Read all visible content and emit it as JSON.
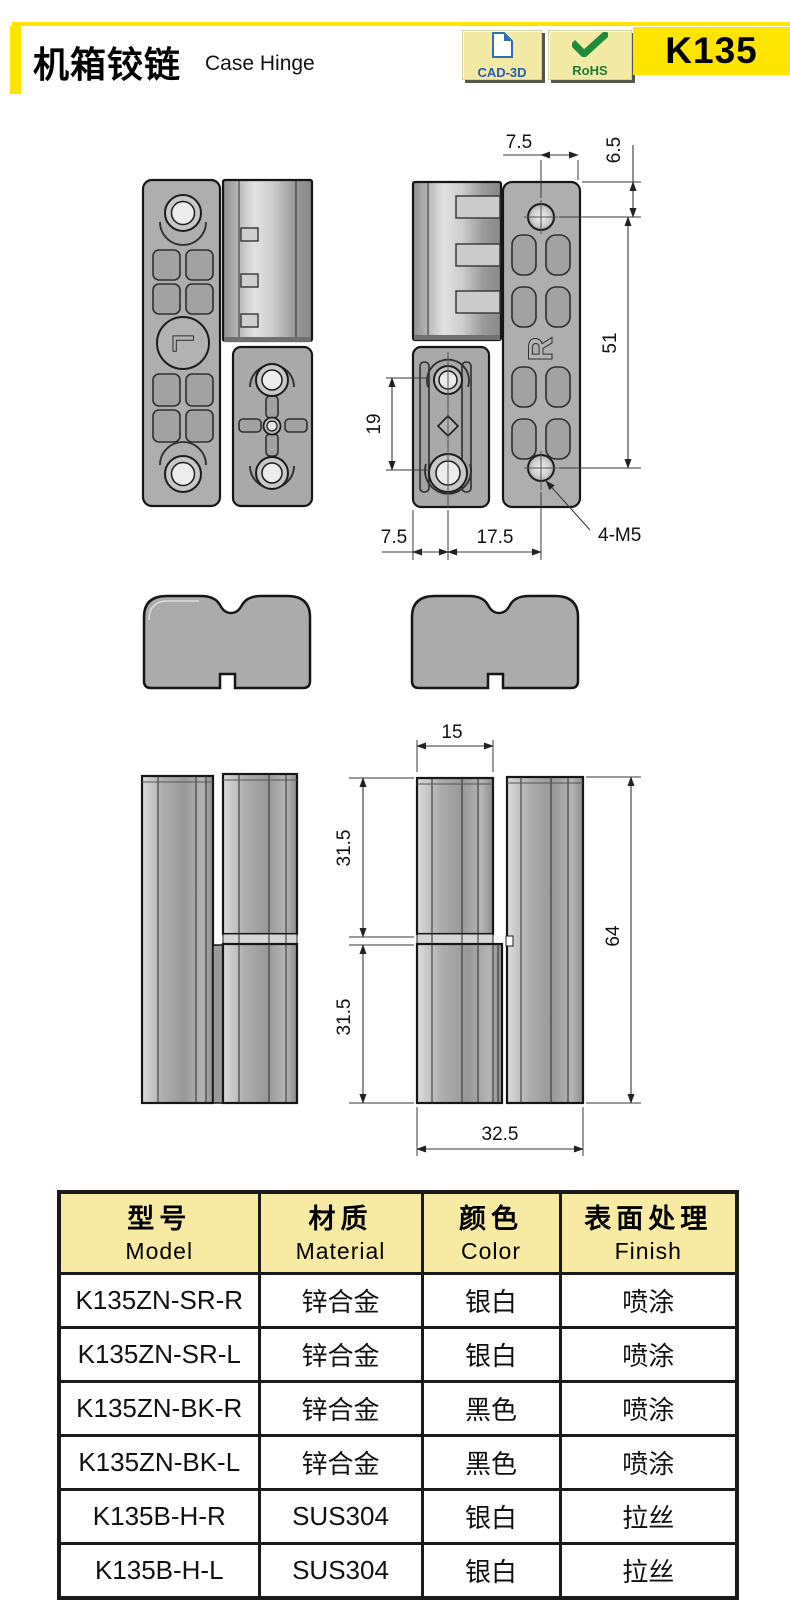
{
  "header": {
    "title_zh": "机箱铰链",
    "title_en": "Case Hinge",
    "product_code": "K135",
    "accent_color": "#FFE400",
    "badges": [
      {
        "label": "CAD-3D",
        "icon": "document-icon",
        "text_color": "#2a5ca8"
      },
      {
        "label": "RoHS",
        "icon": "checkmark-icon",
        "text_color": "#1f7a36"
      }
    ]
  },
  "drawing": {
    "front": {
      "left_marking": "L",
      "right_marking": "R",
      "dims": {
        "hole_to_edge": "7.5",
        "edge_to_hole_top": "6.5",
        "hole_pitch_v": "51",
        "small_plate_pitch": "19",
        "edge_to_center": "7.5",
        "center_to_center": "17.5",
        "thread_note": "4-M5"
      }
    },
    "side": {
      "dims": {
        "leaf_width": "15",
        "upper_half": "31.5",
        "lower_half": "31.5",
        "overall_height": "64",
        "overall_width": "32.5"
      }
    }
  },
  "table": {
    "header_bg": "#F7EBA3",
    "model_col_bg": "#9C9C9C",
    "columns": [
      {
        "zh": "型号",
        "en": "Model"
      },
      {
        "zh": "材质",
        "en": "Material"
      },
      {
        "zh": "颜色",
        "en": "Color"
      },
      {
        "zh": "表面处理",
        "en": "Finish"
      }
    ],
    "rows": [
      {
        "model": "K135ZN-SR-R",
        "material": "锌合金",
        "color": "银白",
        "finish": "喷涂"
      },
      {
        "model": "K135ZN-SR-L",
        "material": "锌合金",
        "color": "银白",
        "finish": "喷涂"
      },
      {
        "model": "K135ZN-BK-R",
        "material": "锌合金",
        "color": "黑色",
        "finish": "喷涂"
      },
      {
        "model": "K135ZN-BK-L",
        "material": "锌合金",
        "color": "黑色",
        "finish": "喷涂"
      },
      {
        "model": "K135B-H-R",
        "material": "SUS304",
        "color": "银白",
        "finish": "拉丝"
      },
      {
        "model": "K135B-H-L",
        "material": "SUS304",
        "color": "银白",
        "finish": "拉丝"
      }
    ]
  }
}
